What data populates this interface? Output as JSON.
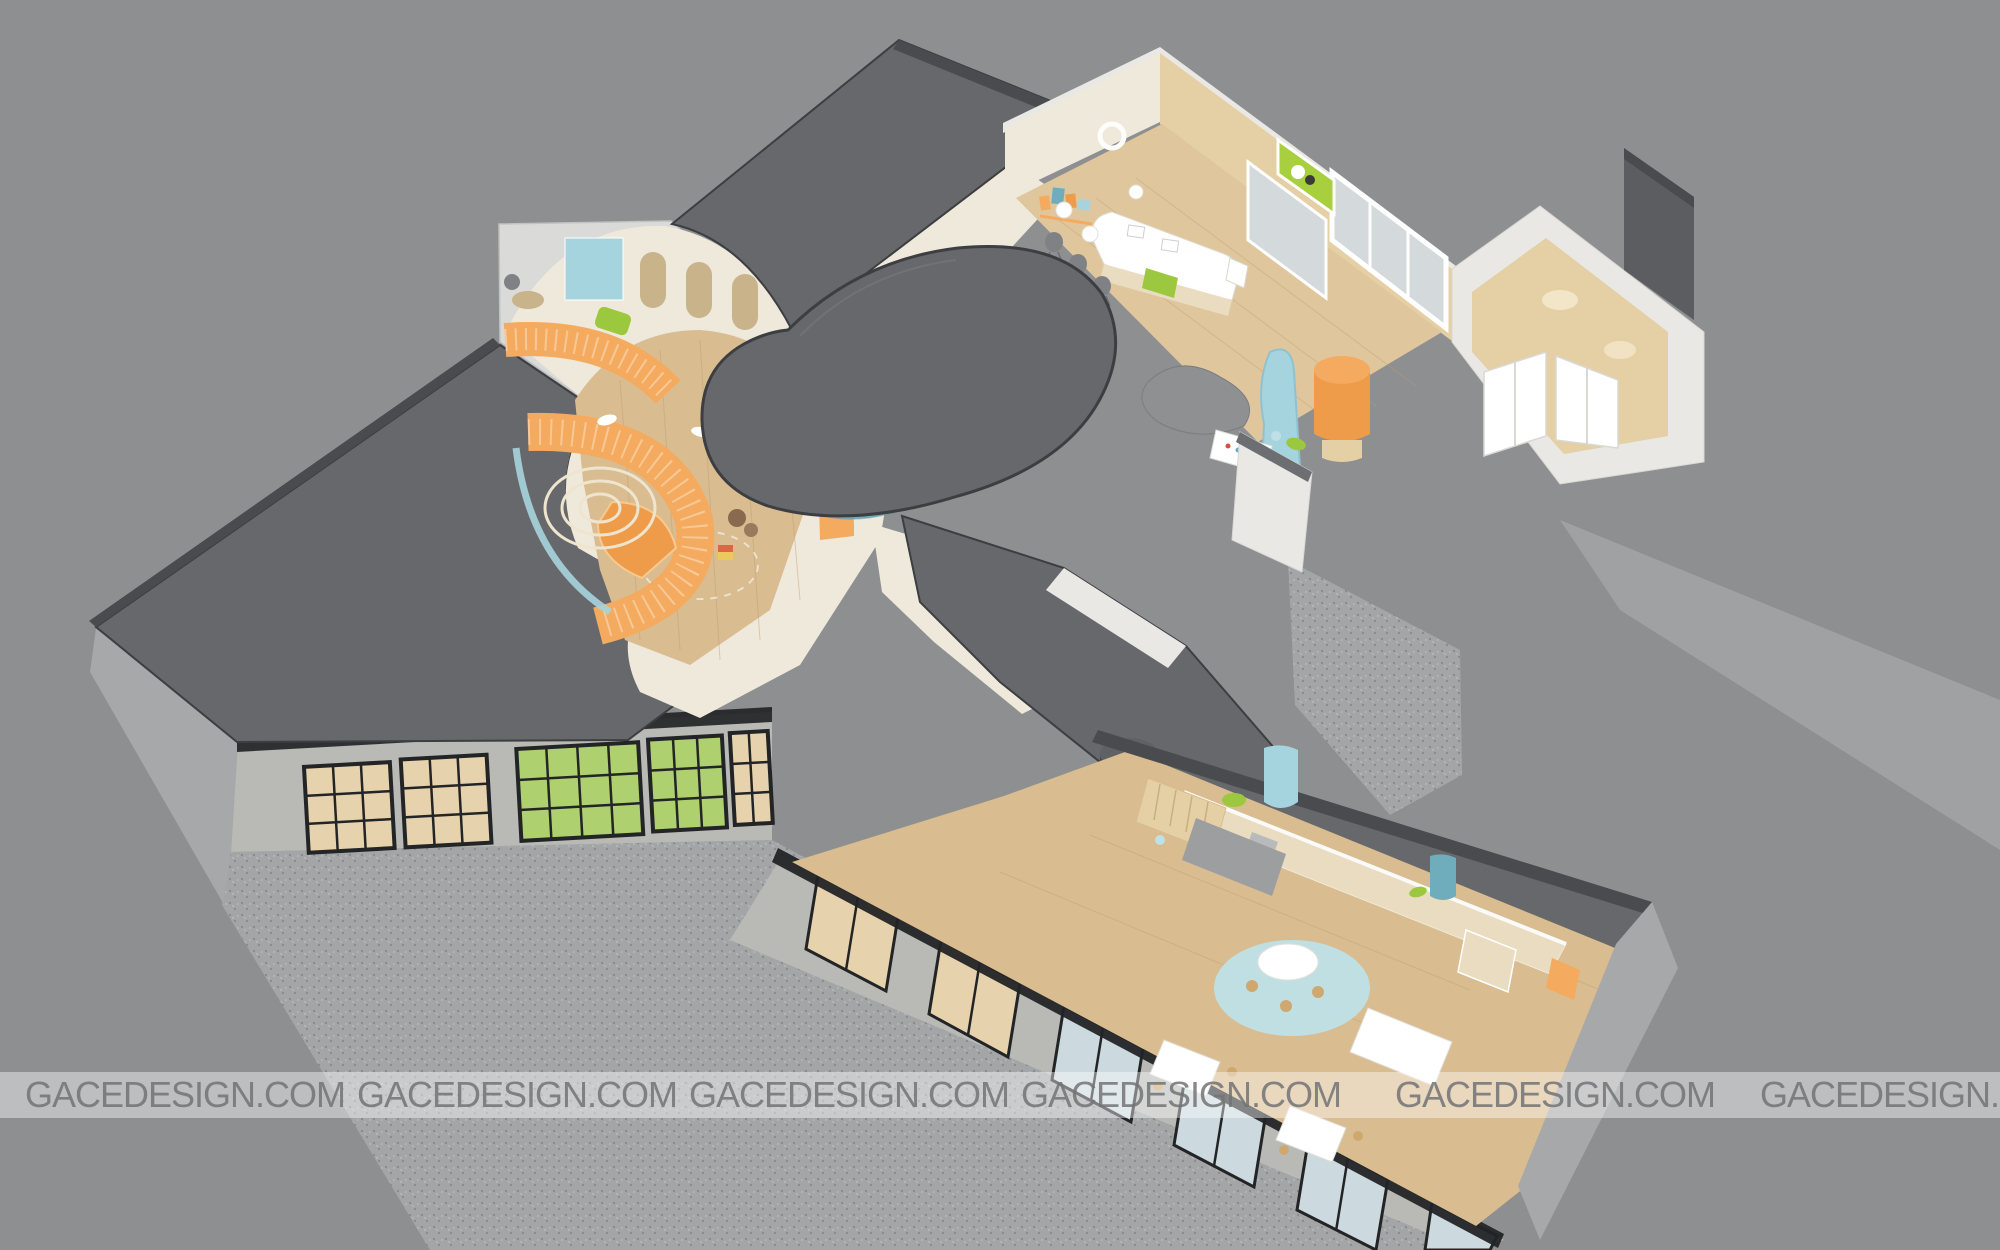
{
  "watermark": {
    "text": "GACEDESIGN.COM",
    "count": 6
  },
  "palette": {
    "bg": "#8e8f91",
    "ground_light": "#a4a5a7",
    "ground_dot_dark": "#88898b",
    "ground_dot_light": "#b7b8ba",
    "roof_dark": "#67686b",
    "roof_darker": "#4a4b4e",
    "roof_edge": "#3d3e41",
    "roof_white": "#dadad8",
    "wall_cream": "#efe9dc",
    "wall_white": "#e9e8e4",
    "wall_gray_light": "#a7a8aa",
    "facade_wall": "#b9bab6",
    "frame_dark": "#232426",
    "glass_cool": "#ccd9de",
    "glass_frost": "#d4d9dc",
    "glass_warm": "#e6d2ac",
    "green_mat": "#aed06e",
    "wood_floor": "#d9bc90",
    "wood_floor_light": "#dfc69d",
    "wood_wall": "#e5cfa5",
    "wood_plank": "#c49e6e",
    "arch_wood": "#c8b38b",
    "sand": "#e9dcc0",
    "orange": "#f4ab5f",
    "orange_deep": "#ee9b4a",
    "teal": "#6fadbd",
    "teal_dark": "#55909f",
    "light_blue": "#a6d4de",
    "pale_blue": "#bfe0e8",
    "green": "#9cc83f",
    "green_bright": "#a8cf3d",
    "yellow": "#ecc95c",
    "gray_chair": "#808184",
    "gray_mat": "#9d9ea0",
    "hill_gray": "#8f9092",
    "wedge_gray": "#5c5d60",
    "drum_gray": "#606164",
    "brown": "#8a6a4e",
    "brown_light": "#9a7a5c",
    "net_cream": "#efe5cf",
    "tan": "#cfa86f",
    "white": "#ffffff",
    "watermark_text": "#737476",
    "watermark_band": "rgba(255,255,255,0.42)"
  }
}
